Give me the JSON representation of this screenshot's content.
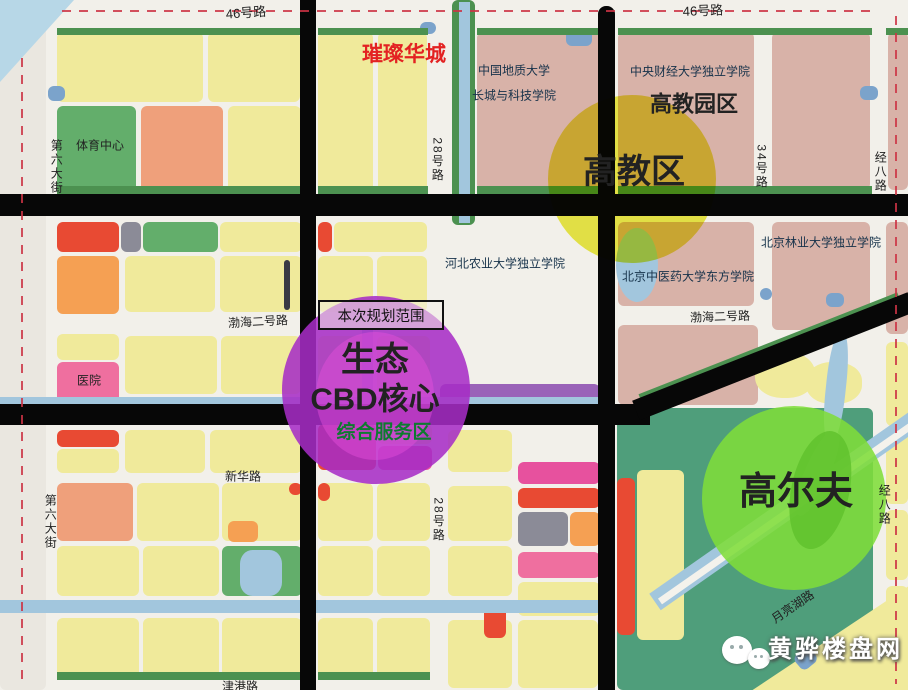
{
  "map_title": "黄骅生态CBD规划图",
  "palette": {
    "Y": "#f0ea9b",
    "P": "#d8b2a8",
    "G": "#63ae6b",
    "O": "#f5a053",
    "SA": "#efa07b",
    "R": "#e84a33",
    "PK": "#ef6f9f",
    "MG": "#e7519e",
    "GY": "#8b8b97",
    "BL": "#7ba3cb",
    "PU": "#9a63b8",
    "TG": "#4f9e7b",
    "DG": "#4c9150",
    "DK": "#3a3a44",
    "CAN": "#a2c6dd",
    "OUT": "#eae7e0",
    "WTR": "#b7d7e7",
    "ROAD": "#f2f0ea",
    "BLACK": "#070707",
    "WHITE": "#f4f2ec"
  },
  "blocks": [
    {
      "x": 0,
      "y": 0,
      "w": 46,
      "h": 690,
      "c": "OUT"
    },
    {
      "x": 0,
      "y": 0,
      "w": 74,
      "h": 82,
      "c": "WTR",
      "clip": "polygon(0 0,100% 0,0 100%)"
    },
    {
      "x": 617,
      "y": 408,
      "w": 256,
      "h": 282,
      "c": "TG"
    },
    {
      "x": 57,
      "y": 32,
      "w": 146,
      "h": 70,
      "c": "Y"
    },
    {
      "x": 208,
      "y": 32,
      "w": 92,
      "h": 70,
      "c": "Y"
    },
    {
      "x": 57,
      "y": 106,
      "w": 79,
      "h": 86,
      "c": "G"
    },
    {
      "x": 141,
      "y": 106,
      "w": 82,
      "h": 86,
      "c": "SA"
    },
    {
      "x": 228,
      "y": 106,
      "w": 73,
      "h": 86,
      "c": "Y"
    },
    {
      "x": 48,
      "y": 86,
      "w": 17,
      "h": 15,
      "c": "BL"
    },
    {
      "x": 318,
      "y": 32,
      "w": 55,
      "h": 160,
      "c": "Y"
    },
    {
      "x": 378,
      "y": 32,
      "w": 49,
      "h": 160,
      "c": "Y"
    },
    {
      "x": 420,
      "y": 22,
      "w": 16,
      "h": 12,
      "c": "BL"
    },
    {
      "x": 452,
      "y": 0,
      "w": 23,
      "h": 225,
      "c": "DG"
    },
    {
      "x": 477,
      "y": 32,
      "w": 126,
      "h": 158,
      "c": "P"
    },
    {
      "x": 566,
      "y": 30,
      "w": 26,
      "h": 16,
      "c": "BL"
    },
    {
      "x": 618,
      "y": 32,
      "w": 136,
      "h": 158,
      "c": "P"
    },
    {
      "x": 772,
      "y": 32,
      "w": 98,
      "h": 158,
      "c": "P"
    },
    {
      "x": 860,
      "y": 86,
      "w": 18,
      "h": 14,
      "c": "BL"
    },
    {
      "x": 888,
      "y": 32,
      "w": 20,
      "h": 158,
      "c": "P"
    },
    {
      "x": 57,
      "y": 222,
      "w": 62,
      "h": 30,
      "c": "R"
    },
    {
      "x": 121,
      "y": 222,
      "w": 20,
      "h": 30,
      "c": "GY"
    },
    {
      "x": 143,
      "y": 222,
      "w": 75,
      "h": 30,
      "c": "G"
    },
    {
      "x": 220,
      "y": 222,
      "w": 82,
      "h": 30,
      "c": "Y"
    },
    {
      "x": 318,
      "y": 222,
      "w": 14,
      "h": 30,
      "c": "R"
    },
    {
      "x": 334,
      "y": 222,
      "w": 93,
      "h": 30,
      "c": "Y"
    },
    {
      "x": 57,
      "y": 256,
      "w": 62,
      "h": 58,
      "c": "O"
    },
    {
      "x": 125,
      "y": 256,
      "w": 90,
      "h": 56,
      "c": "Y"
    },
    {
      "x": 220,
      "y": 256,
      "w": 82,
      "h": 56,
      "c": "Y"
    },
    {
      "x": 284,
      "y": 260,
      "w": 6,
      "h": 50,
      "c": "DK"
    },
    {
      "x": 318,
      "y": 256,
      "w": 55,
      "h": 56,
      "c": "Y"
    },
    {
      "x": 377,
      "y": 256,
      "w": 50,
      "h": 56,
      "c": "Y"
    },
    {
      "x": 57,
      "y": 334,
      "w": 62,
      "h": 26,
      "c": "Y"
    },
    {
      "x": 125,
      "y": 336,
      "w": 92,
      "h": 58,
      "c": "Y"
    },
    {
      "x": 221,
      "y": 336,
      "w": 80,
      "h": 58,
      "c": "Y"
    },
    {
      "x": 318,
      "y": 336,
      "w": 55,
      "h": 58,
      "c": "Y"
    },
    {
      "x": 377,
      "y": 336,
      "w": 53,
      "h": 58,
      "c": "Y"
    },
    {
      "x": 57,
      "y": 362,
      "w": 62,
      "h": 42,
      "c": "PK"
    },
    {
      "x": 440,
      "y": 384,
      "w": 160,
      "h": 18,
      "c": "PU"
    },
    {
      "x": 618,
      "y": 222,
      "w": 136,
      "h": 84,
      "c": "P"
    },
    {
      "x": 772,
      "y": 222,
      "w": 98,
      "h": 108,
      "c": "P"
    },
    {
      "x": 826,
      "y": 293,
      "w": 18,
      "h": 14,
      "c": "BL"
    },
    {
      "x": 760,
      "y": 288,
      "w": 12,
      "h": 12,
      "c": "BL"
    },
    {
      "x": 618,
      "y": 325,
      "w": 140,
      "h": 80,
      "c": "P"
    },
    {
      "x": 886,
      "y": 222,
      "w": 22,
      "h": 112,
      "c": "P"
    },
    {
      "x": 886,
      "y": 342,
      "w": 22,
      "h": 84,
      "c": "Y"
    },
    {
      "x": 57,
      "y": 430,
      "w": 62,
      "h": 17,
      "c": "R"
    },
    {
      "x": 57,
      "y": 449,
      "w": 62,
      "h": 24,
      "c": "Y"
    },
    {
      "x": 125,
      "y": 430,
      "w": 80,
      "h": 43,
      "c": "Y"
    },
    {
      "x": 210,
      "y": 430,
      "w": 92,
      "h": 43,
      "c": "Y"
    },
    {
      "x": 318,
      "y": 424,
      "w": 58,
      "h": 46,
      "c": "R"
    },
    {
      "x": 378,
      "y": 446,
      "w": 54,
      "h": 24,
      "c": "MG"
    },
    {
      "x": 378,
      "y": 424,
      "w": 54,
      "h": 20,
      "c": "Y"
    },
    {
      "x": 57,
      "y": 483,
      "w": 76,
      "h": 58,
      "c": "SA"
    },
    {
      "x": 137,
      "y": 483,
      "w": 82,
      "h": 58,
      "c": "Y"
    },
    {
      "x": 222,
      "y": 483,
      "w": 80,
      "h": 58,
      "c": "Y"
    },
    {
      "x": 228,
      "y": 521,
      "w": 30,
      "h": 21,
      "c": "O"
    },
    {
      "x": 289,
      "y": 483,
      "w": 13,
      "h": 12,
      "c": "R"
    },
    {
      "x": 318,
      "y": 483,
      "w": 55,
      "h": 58,
      "c": "Y"
    },
    {
      "x": 318,
      "y": 483,
      "w": 12,
      "h": 18,
      "c": "R"
    },
    {
      "x": 377,
      "y": 483,
      "w": 53,
      "h": 58,
      "c": "Y"
    },
    {
      "x": 57,
      "y": 546,
      "w": 82,
      "h": 50,
      "c": "Y"
    },
    {
      "x": 143,
      "y": 546,
      "w": 76,
      "h": 50,
      "c": "Y"
    },
    {
      "x": 222,
      "y": 546,
      "w": 80,
      "h": 50,
      "c": "G"
    },
    {
      "x": 318,
      "y": 546,
      "w": 55,
      "h": 50,
      "c": "Y"
    },
    {
      "x": 377,
      "y": 546,
      "w": 53,
      "h": 50,
      "c": "Y"
    },
    {
      "x": 57,
      "y": 618,
      "w": 82,
      "h": 60,
      "c": "Y"
    },
    {
      "x": 143,
      "y": 618,
      "w": 76,
      "h": 60,
      "c": "Y"
    },
    {
      "x": 222,
      "y": 618,
      "w": 80,
      "h": 60,
      "c": "Y"
    },
    {
      "x": 318,
      "y": 618,
      "w": 55,
      "h": 60,
      "c": "Y"
    },
    {
      "x": 377,
      "y": 618,
      "w": 53,
      "h": 60,
      "c": "Y"
    },
    {
      "x": 448,
      "y": 430,
      "w": 64,
      "h": 42,
      "c": "Y"
    },
    {
      "x": 448,
      "y": 486,
      "w": 64,
      "h": 55,
      "c": "Y"
    },
    {
      "x": 448,
      "y": 546,
      "w": 64,
      "h": 50,
      "c": "Y"
    },
    {
      "x": 448,
      "y": 620,
      "w": 64,
      "h": 68,
      "c": "Y"
    },
    {
      "x": 518,
      "y": 462,
      "w": 82,
      "h": 22,
      "c": "MG"
    },
    {
      "x": 518,
      "y": 488,
      "w": 82,
      "h": 20,
      "c": "R"
    },
    {
      "x": 518,
      "y": 512,
      "w": 50,
      "h": 34,
      "c": "GY"
    },
    {
      "x": 570,
      "y": 512,
      "w": 30,
      "h": 34,
      "c": "O"
    },
    {
      "x": 518,
      "y": 552,
      "w": 82,
      "h": 26,
      "c": "PK"
    },
    {
      "x": 518,
      "y": 582,
      "w": 82,
      "h": 34,
      "c": "Y"
    },
    {
      "x": 484,
      "y": 604,
      "w": 22,
      "h": 34,
      "c": "R"
    },
    {
      "x": 518,
      "y": 620,
      "w": 80,
      "h": 68,
      "c": "Y"
    },
    {
      "x": 617,
      "y": 478,
      "w": 18,
      "h": 157,
      "c": "R"
    },
    {
      "x": 637,
      "y": 470,
      "w": 47,
      "h": 170,
      "c": "Y"
    },
    {
      "x": 755,
      "y": 352,
      "w": 60,
      "h": 46,
      "c": "Y",
      "r": "45%"
    },
    {
      "x": 806,
      "y": 362,
      "w": 56,
      "h": 42,
      "c": "Y",
      "r": "45%"
    },
    {
      "x": 886,
      "y": 432,
      "w": 22,
      "h": 72,
      "c": "Y"
    },
    {
      "x": 886,
      "y": 510,
      "w": 22,
      "h": 70,
      "c": "Y"
    },
    {
      "x": 886,
      "y": 586,
      "w": 22,
      "h": 102,
      "c": "Y"
    },
    {
      "x": 698,
      "y": 575,
      "w": 210,
      "h": 115,
      "c": "Y",
      "clip": "polygon(26% 100%,100% 10%,100% 100%)"
    },
    {
      "x": 798,
      "y": 656,
      "w": 20,
      "h": 18,
      "c": "BL",
      "rot": -40
    }
  ],
  "green_strips": [
    {
      "x": 57,
      "y": 28,
      "w": 246,
      "h": 7
    },
    {
      "x": 318,
      "y": 28,
      "w": 110,
      "h": 7
    },
    {
      "x": 477,
      "y": 28,
      "w": 126,
      "h": 7
    },
    {
      "x": 618,
      "y": 28,
      "w": 254,
      "h": 7
    },
    {
      "x": 886,
      "y": 28,
      "w": 22,
      "h": 7
    },
    {
      "x": 57,
      "y": 186,
      "w": 246,
      "h": 8
    },
    {
      "x": 318,
      "y": 186,
      "w": 110,
      "h": 8
    },
    {
      "x": 477,
      "y": 186,
      "w": 126,
      "h": 8
    },
    {
      "x": 618,
      "y": 186,
      "w": 254,
      "h": 8
    },
    {
      "x": 57,
      "y": 672,
      "w": 246,
      "h": 8
    },
    {
      "x": 318,
      "y": 672,
      "w": 112,
      "h": 8
    },
    {
      "x": 640,
      "y": 394,
      "w": 278,
      "h": 8,
      "rot": -21.5
    }
  ],
  "canals": [
    {
      "x": 459,
      "y": 2,
      "w": 11,
      "h": 221,
      "c": "CAN"
    },
    {
      "x": 362,
      "y": 330,
      "w": 11,
      "h": 68,
      "c": "CAN"
    },
    {
      "x": 0,
      "y": 397,
      "w": 605,
      "h": 11,
      "c": "CAN"
    },
    {
      "x": 0,
      "y": 600,
      "w": 605,
      "h": 13,
      "c": "CAN"
    },
    {
      "x": 616,
      "y": 228,
      "w": 42,
      "h": 74,
      "c": "CAN",
      "r": "50%"
    },
    {
      "x": 240,
      "y": 550,
      "w": 42,
      "h": 46,
      "c": "CAN",
      "r": "30%"
    },
    {
      "x": 826,
      "y": 330,
      "w": 20,
      "h": 112,
      "c": "CAN",
      "r": "45%",
      "rot": 6
    },
    {
      "x": 806,
      "y": 422,
      "w": 24,
      "h": 92,
      "c": "CAN",
      "r": "45%",
      "rot": 24
    },
    {
      "x": 655,
      "y": 592,
      "w": 330,
      "h": 20,
      "c": "CAN",
      "rot": -35
    },
    {
      "x": 660,
      "y": 598,
      "w": 320,
      "h": 7,
      "c": "WHITE",
      "rot": -35
    }
  ],
  "black_roads": [
    {
      "x": 0,
      "y": 194,
      "w": 908,
      "h": 22
    },
    {
      "x": 0,
      "y": 404,
      "w": 650,
      "h": 21
    },
    {
      "x": 300,
      "y": 0,
      "w": 16,
      "h": 690
    },
    {
      "x": 598,
      "y": 6,
      "w": 17,
      "h": 684,
      "r": "8px 8px 0 0"
    },
    {
      "x": 636,
      "y": 400,
      "w": 296,
      "h": 21,
      "rot": -21.5
    }
  ],
  "dashes": [
    {
      "x": 62,
      "y": 10,
      "w": 812,
      "h": 2,
      "dir": "h"
    },
    {
      "x": 21,
      "y": 58,
      "w": 2,
      "h": 628,
      "dir": "v"
    },
    {
      "x": 895,
      "y": 16,
      "w": 2,
      "h": 668,
      "dir": "v"
    }
  ],
  "circles": [
    {
      "name": "higher-ed-circle",
      "x": 548,
      "y": 95,
      "d": 168,
      "color": "rgba(233,233,35,0.82)",
      "blend": "multiply"
    },
    {
      "name": "cbd-circle",
      "x": 282,
      "y": 296,
      "d": 188,
      "color": "rgba(167,45,198,0.87)",
      "blend": "normal"
    },
    {
      "name": "cbd-inner-blob",
      "x": 316,
      "y": 332,
      "d": 0,
      "w": 118,
      "h": 128,
      "color": "rgba(230,80,220,0.45)",
      "blend": "normal"
    },
    {
      "name": "golf-circle",
      "x": 702,
      "y": 406,
      "d": 184,
      "color": "rgba(128,221,58,0.88)",
      "blend": "normal"
    },
    {
      "name": "golf-leaf",
      "x": 792,
      "y": 424,
      "d": 0,
      "w": 58,
      "h": 120,
      "color": "rgba(95,192,44,0.8)",
      "blend": "normal",
      "rot": 12
    }
  ],
  "labels": [
    {
      "n": "road-label-46-west",
      "t": "46号路",
      "x": 246,
      "y": 13,
      "s": 13,
      "rot": -4
    },
    {
      "n": "road-label-46-east",
      "t": "46号路",
      "x": 703,
      "y": 11,
      "s": 13,
      "rot": -2
    },
    {
      "n": "cuican-huacheng-label",
      "t": "璀璨华城",
      "x": 404,
      "y": 55,
      "s": 21,
      "b": 1,
      "c": "#e32222"
    },
    {
      "n": "cugb-label-line1",
      "t": "中国地质大学",
      "x": 514,
      "y": 71,
      "s": 12,
      "c": "#16324a"
    },
    {
      "n": "cugb-label-line2",
      "t": "长城与科技学院",
      "x": 514,
      "y": 96,
      "s": 12,
      "c": "#16324a"
    },
    {
      "n": "cufe-label",
      "t": "中央财经大学独立学院",
      "x": 690,
      "y": 72,
      "s": 12,
      "c": "#16324a"
    },
    {
      "n": "gaojiao-park-label",
      "t": "高教园区",
      "x": 694,
      "y": 104,
      "s": 22,
      "b": 1
    },
    {
      "n": "gaojiao-zone-label",
      "t": "高教区",
      "x": 634,
      "y": 173,
      "s": 34,
      "b": 1
    },
    {
      "n": "bjfu-label",
      "t": "北京林业大学独立学院",
      "x": 821,
      "y": 243,
      "s": 12,
      "c": "#16324a"
    },
    {
      "n": "hebau-label",
      "t": "河北农业大学独立学院",
      "x": 505,
      "y": 264,
      "s": 12,
      "c": "#16324a"
    },
    {
      "n": "bucm-label",
      "t": "北京中医药大学东方学院",
      "x": 688,
      "y": 277,
      "s": 12,
      "c": "#16324a"
    },
    {
      "n": "bohai2-label-west",
      "t": "渤海二号路",
      "x": 258,
      "y": 322,
      "s": 12,
      "rot": -3
    },
    {
      "n": "bohai2-label-east",
      "t": "渤海二号路",
      "x": 720,
      "y": 317,
      "s": 12,
      "rot": -2
    },
    {
      "n": "eco-label",
      "t": "生态",
      "x": 375,
      "y": 361,
      "s": 34,
      "b": 1
    },
    {
      "n": "cbd-core-label",
      "t": "CBD核心",
      "x": 375,
      "y": 400,
      "s": 31,
      "b": 1
    },
    {
      "n": "service-zone-label",
      "t": "综合服务区",
      "x": 384,
      "y": 433,
      "s": 19,
      "b": 1,
      "c": "#0e7a30"
    },
    {
      "n": "hospital-label",
      "t": "医院",
      "x": 89,
      "y": 381,
      "s": 12
    },
    {
      "n": "sports-center-label",
      "t": "体育中心",
      "x": 100,
      "y": 146,
      "s": 12
    },
    {
      "n": "xinhua-road-label",
      "t": "新华路",
      "x": 243,
      "y": 477,
      "s": 12
    },
    {
      "n": "golf-label",
      "t": "高尔夫",
      "x": 796,
      "y": 493,
      "s": 38,
      "b": 1
    },
    {
      "n": "street6-label-top",
      "t": "第六大街",
      "x": 56,
      "y": 167,
      "s": 12,
      "v": 1
    },
    {
      "n": "street6-label-bottom",
      "t": "第六大街",
      "x": 50,
      "y": 522,
      "s": 12,
      "v": 1
    },
    {
      "n": "road28-label-top",
      "t": "28号路",
      "x": 437,
      "y": 160,
      "s": 12,
      "v": 1
    },
    {
      "n": "road28-label-bottom",
      "t": "28号路",
      "x": 438,
      "y": 520,
      "s": 12,
      "v": 1
    },
    {
      "n": "road34-label",
      "t": "34号路",
      "x": 761,
      "y": 167,
      "s": 12,
      "v": 1
    },
    {
      "n": "jingba-label-top",
      "t": "经八路",
      "x": 880,
      "y": 172,
      "s": 12,
      "v": 1
    },
    {
      "n": "jingba-label-bottom",
      "t": "经八路",
      "x": 884,
      "y": 505,
      "s": 12,
      "v": 1
    },
    {
      "n": "moon-lake-road-label",
      "t": "月亮湖路",
      "x": 793,
      "y": 607,
      "s": 12,
      "rot": -34
    },
    {
      "n": "jingang-road-label",
      "t": "津港路",
      "x": 240,
      "y": 687,
      "s": 12
    }
  ],
  "planning_box": {
    "x": 318,
    "y": 300,
    "w": 122,
    "h": 26,
    "text": "本次规划范围"
  },
  "watermark": {
    "text": "黄骅楼盘网"
  }
}
